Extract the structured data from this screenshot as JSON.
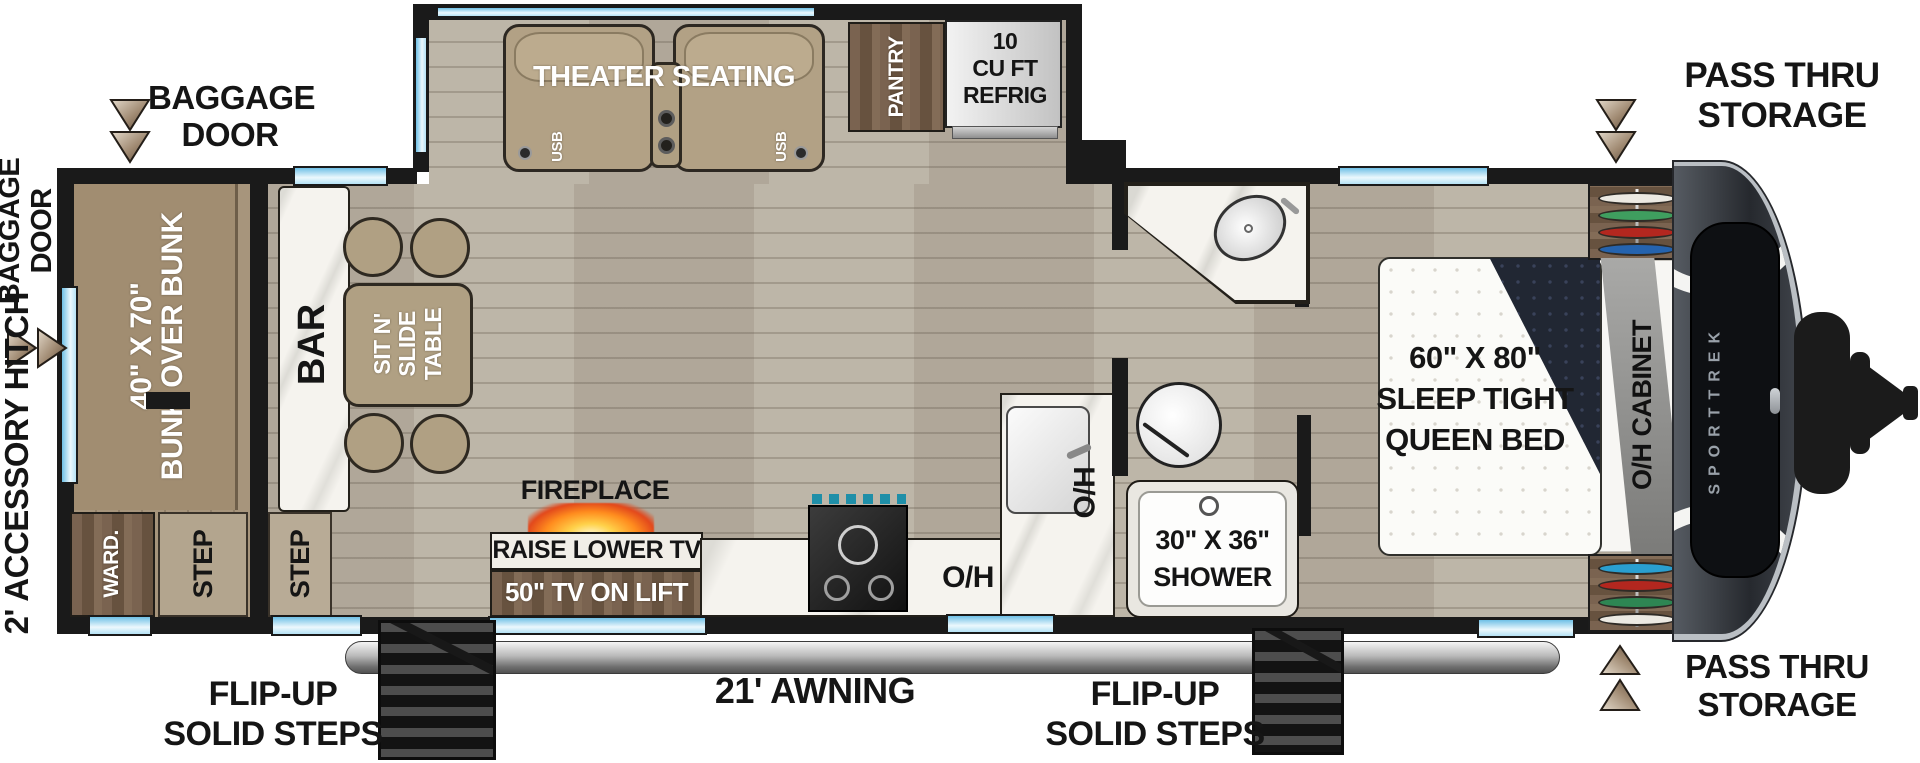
{
  "floorplan": {
    "brand": "SPORTTREK",
    "callouts": {
      "baggage_top": {
        "l1": "BAGGAGE",
        "l2": "DOOR"
      },
      "baggage_left": {
        "l1": "BAGGAGE",
        "l2": "DOOR"
      },
      "hitch_note": "2' ACCESSORY HITCH",
      "pass_thru_top": {
        "l1": "PASS THRU",
        "l2": "STORAGE"
      },
      "pass_thru_bottom": {
        "l1": "PASS THRU",
        "l2": "STORAGE"
      },
      "awning": "21' AWNING",
      "steps_left": {
        "l1": "FLIP-UP",
        "l2": "SOLID STEPS"
      },
      "steps_right": {
        "l1": "FLIP-UP",
        "l2": "SOLID STEPS"
      }
    },
    "features": {
      "bunk": {
        "l1": "40\" X 70\"",
        "l2": "BUNK OVER BUNK"
      },
      "ward": "WARD.",
      "step_bunk": "STEP",
      "step_main": "STEP",
      "bar": "BAR",
      "table": {
        "l1": "SIT N'",
        "l2": "SLIDE",
        "l3": "TABLE"
      },
      "theater": "THEATER SEATING",
      "usb": "USB",
      "pantry": "PANTRY",
      "refrig": {
        "l1": "10",
        "l2": "CU FT",
        "l3": "REFRIG"
      },
      "fireplace": "FIREPLACE",
      "tv_raise": "RAISE LOWER TV",
      "tv_lift": "50\" TV ON LIFT",
      "oh": "O/H",
      "shower": {
        "l1": "30\" X 36\"",
        "l2": "SHOWER"
      },
      "bed": {
        "l1": "60\" X 80\"",
        "l2": "SLEEP TIGHT",
        "l3": "QUEEN BED"
      },
      "oh_cabinet": "O/H CABINET"
    },
    "hangers": {
      "top": [
        "#ece9e2",
        "#3f9e5f",
        "#b3271f",
        "#2563ae"
      ],
      "bottom": [
        "#2a9fd0",
        "#b3271f",
        "#2e8653",
        "#ece9e2"
      ]
    },
    "colors": {
      "wall": "#1a1a1a",
      "floor": "#b9b1a3",
      "bunk_floor": "#a7957c",
      "furniture_tan": "#b0a083",
      "cabinet_wood": "#6d5845",
      "counter_marble": "#f5f3ee",
      "window_glass": "#a8d9ef",
      "fireplace_glow": "#ff8c1e",
      "front_cap": "#2c2f35"
    }
  }
}
